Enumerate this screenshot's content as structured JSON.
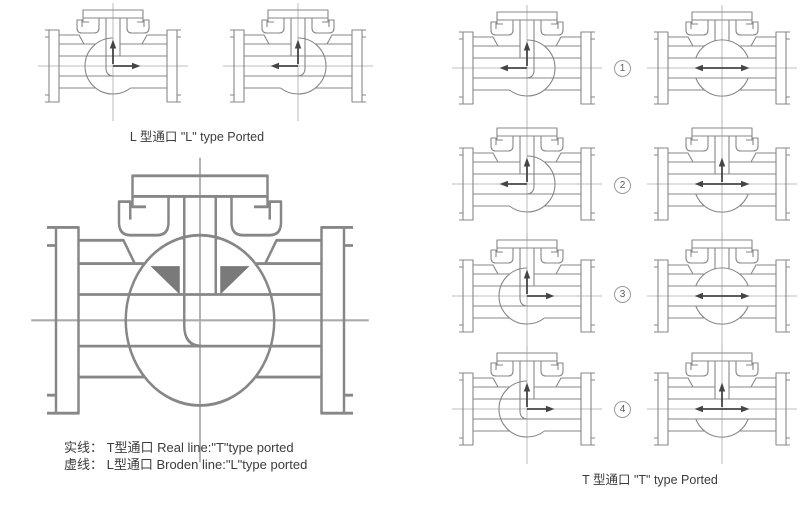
{
  "colors": {
    "line": "#878787",
    "centerline": "#ababab",
    "arrow": "#454545",
    "seat_fill": "#7a7a7a",
    "text": "#3c3c3c",
    "background": "#ffffff"
  },
  "left_panel": {
    "l_type_caption": "L 型通口 \"L\" type Ported",
    "legend": {
      "solid_line": "实线： T型通口 Real line:\"T\"type ported",
      "dashed_line": "虚线： L型通口 Broden line:\"L\"type ported"
    },
    "small_valves": [
      {
        "name": "valve-l-port-up-right",
        "kind": "L",
        "dir": "right",
        "arrows": [
          "up",
          "right"
        ]
      },
      {
        "name": "valve-l-port-up-left",
        "kind": "L",
        "dir": "left",
        "arrows": [
          "up",
          "left"
        ]
      }
    ],
    "section_valve": {
      "name": "valve-t-port-section",
      "kind": "big",
      "arrows": []
    }
  },
  "right_panel": {
    "t_type_caption": "T 型通口 \"T\" type Ported",
    "rows": [
      {
        "num": "1",
        "left": {
          "kind": "L",
          "dir": "left",
          "arrows": [
            "up",
            "left"
          ]
        },
        "right": {
          "kind": "through",
          "arrows": [
            "left",
            "right"
          ]
        }
      },
      {
        "num": "2",
        "left": {
          "kind": "L",
          "dir": "left",
          "arrows": [
            "up",
            "left"
          ]
        },
        "right": {
          "kind": "tee",
          "arrows": [
            "up",
            "left",
            "right"
          ]
        }
      },
      {
        "num": "3",
        "left": {
          "kind": "L",
          "dir": "right",
          "arrows": [
            "up",
            "right"
          ]
        },
        "right": {
          "kind": "through",
          "arrows": [
            "left",
            "right"
          ]
        }
      },
      {
        "num": "4",
        "left": {
          "kind": "L",
          "dir": "right",
          "arrows": [
            "up",
            "right"
          ]
        },
        "right": {
          "kind": "tee",
          "arrows": [
            "up",
            "left",
            "right"
          ]
        }
      }
    ]
  }
}
